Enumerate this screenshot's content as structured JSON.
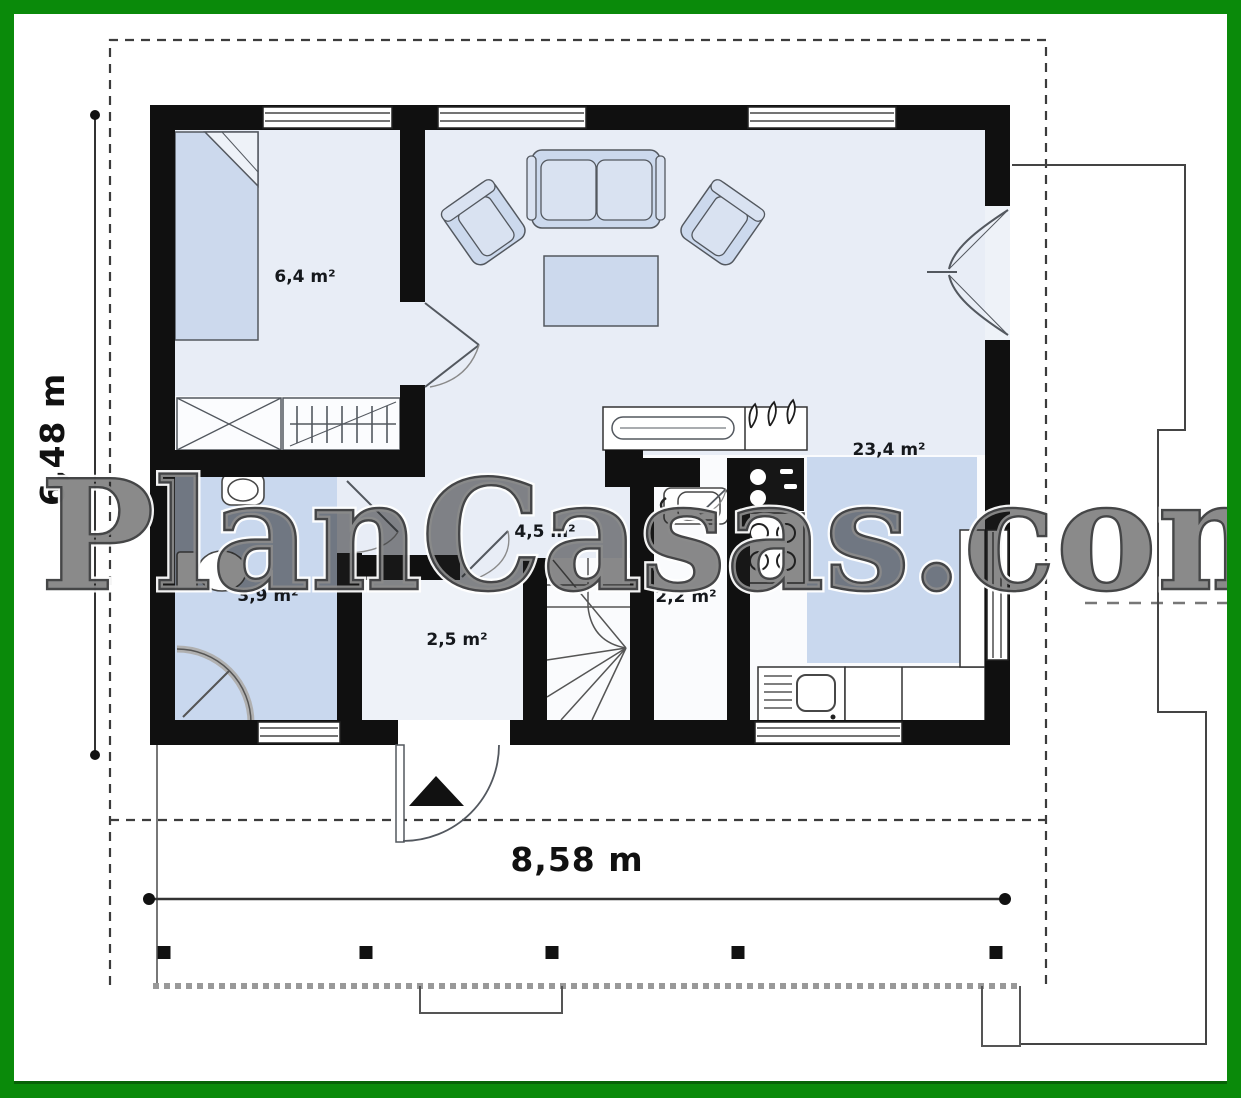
{
  "watermark": {
    "text": "PlanCasas.com"
  },
  "dimensions": {
    "width": "8,58 m",
    "height": "6,48 m"
  },
  "rooms": {
    "bedroom": {
      "area": "6,4 m²"
    },
    "living": {
      "area": "23,4 m²"
    },
    "hall": {
      "area": "4,5 m²"
    },
    "bathroom": {
      "area": "3,9 m²"
    },
    "vestibule": {
      "area": "2,5 m²"
    },
    "wc": {
      "area": "2,2 m²"
    }
  },
  "colors": {
    "frame_green": "#0a8a0a",
    "wall_black": "#101010",
    "floor_light": "#e8edf6",
    "floor_blue": "#c9d8ee",
    "furniture_fill": "#ccd9ed",
    "line_gray": "#444444"
  }
}
